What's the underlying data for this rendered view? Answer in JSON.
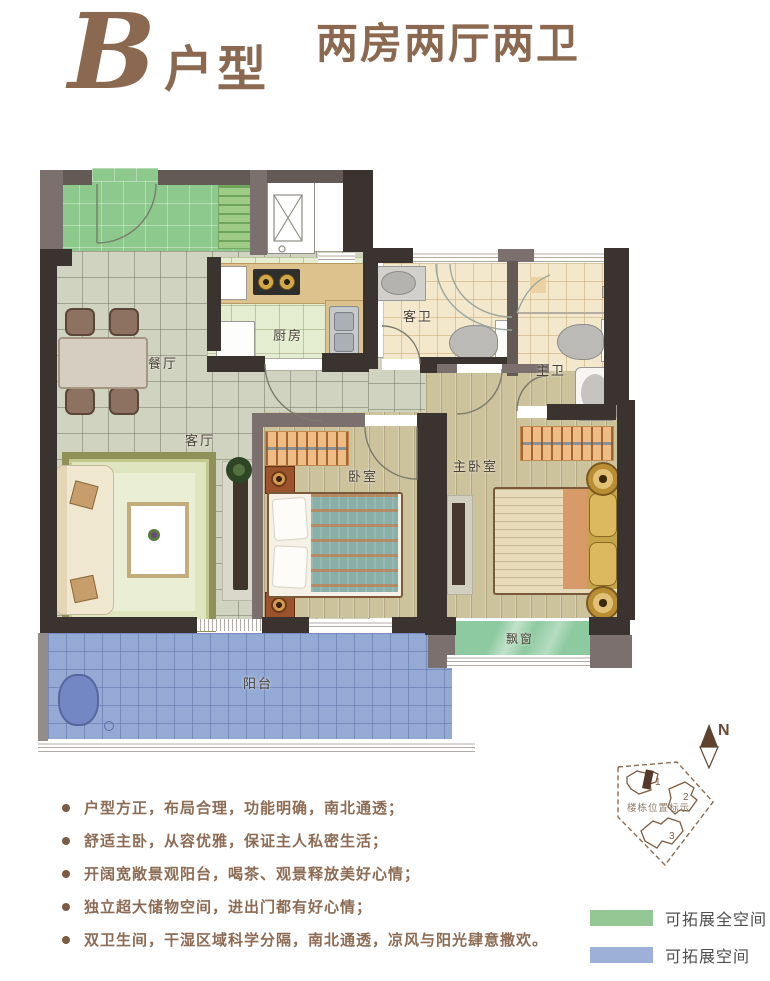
{
  "title": {
    "letter": "B",
    "type_label": "户型",
    "subtitle": "两房两厅两卫"
  },
  "rooms": {
    "dining": "餐厅",
    "kitchen": "厨房",
    "living": "客厅",
    "guest_bath": "客卫",
    "master_bath": "主卫",
    "bedroom": "卧室",
    "master_bedroom": "主卧室",
    "bay_window": "飘窗",
    "balcony": "阳台"
  },
  "features": [
    "户型方正，布局合理，功能明确，南北通透；",
    "舒适主卧，从容优雅，保证主人私密生活；",
    "开阔宽敞景观阳台，喝茶、观景释放美好心情；",
    "独立超大储物空间，进出门都有好心情；",
    "双卫生间，干湿区域科学分隔，南北通透，凉风与阳光肆意撒欢。"
  ],
  "compass": {
    "north": "N"
  },
  "site_plan": {
    "label": "楼栋位置标示",
    "buildings": [
      "1",
      "2",
      "3"
    ]
  },
  "legend": [
    {
      "label": "可拓展全空间",
      "swatch_style": "background:#95c795"
    },
    {
      "label": "可拓展空间",
      "swatch_style": "background:#9db1d8"
    }
  ],
  "colors": {
    "accent_brown": "#8a6950",
    "expand_full_green": "#8dc88d",
    "expand_blue": "#94aad4",
    "wall_dark": "#3a332f"
  }
}
